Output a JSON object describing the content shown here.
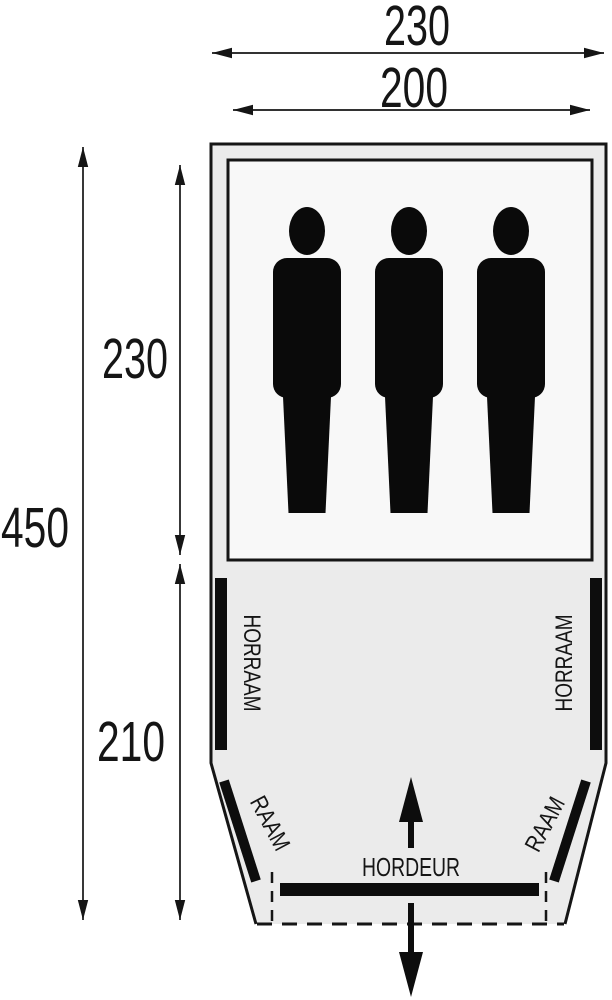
{
  "diagram": {
    "kind": "tent-floorplan",
    "dimensions": {
      "top_width": "230",
      "inner_width": "200",
      "total_length": "450",
      "sleeping_length": "230",
      "living_length": "210"
    },
    "labels": {
      "left_mesh_window": "HORRAAM",
      "right_mesh_window": "HORRAAM",
      "left_front_window": "RAAM",
      "right_front_window": "RAAM",
      "front_door": "HORDEUR"
    },
    "sleeping_area": {
      "person_count": 3
    },
    "colors": {
      "line": "#151515",
      "tent_fill": "#ebebeb",
      "sleeping_area_fill": "#f8f8f8",
      "silhouette": "#0a0a0a",
      "bar": "#0d0d0d",
      "background": "#ffffff"
    }
  }
}
